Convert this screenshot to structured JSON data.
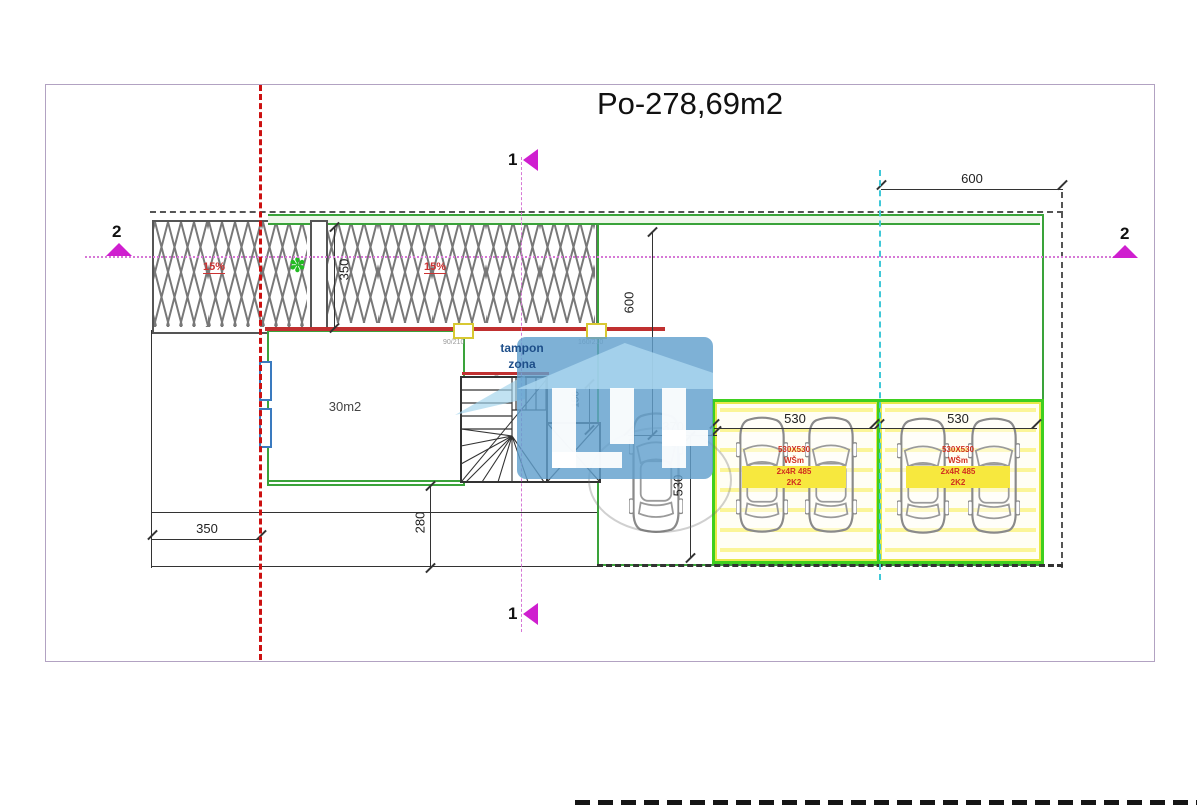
{
  "title": "Po-278,69m2",
  "plan": {
    "room_area": "30m2",
    "tampon_line1": "tampon",
    "tampon_line2": "zona",
    "slope_left": "15%",
    "slope_main": "15%"
  },
  "dimensions": {
    "top_600": "600",
    "mid_600": "600",
    "ramp_350": "350",
    "stair_156": "156",
    "car_370": "370",
    "vert_530": "530",
    "box1_530": "530",
    "box2_530": "530",
    "bottom_350": "350",
    "left_280": "280"
  },
  "sections": {
    "marker_1_top": "1",
    "marker_1_bottom": "1",
    "marker_2_left": "2",
    "marker_2_right": "2"
  },
  "doors": {
    "door1": "90/210",
    "door2": "160/210",
    "stair_door": "90/210"
  },
  "parking1": {
    "lines": [
      "530X530",
      "WŠm",
      "2x4R 485",
      "2K2"
    ]
  },
  "parking2": {
    "lines": [
      "530X530",
      "WŠm",
      "2x4R 485",
      "2K2"
    ]
  },
  "colors": {
    "wall_green": "#3aa33a",
    "parking_green": "#3fcf1f",
    "highlight_yellow": "#f3e84a",
    "boundary_red": "#cc2222",
    "section_magenta": "#cf1fcf",
    "axis_cyan": "#3fc8d8",
    "watermark_blue": "#5f9fcd"
  }
}
